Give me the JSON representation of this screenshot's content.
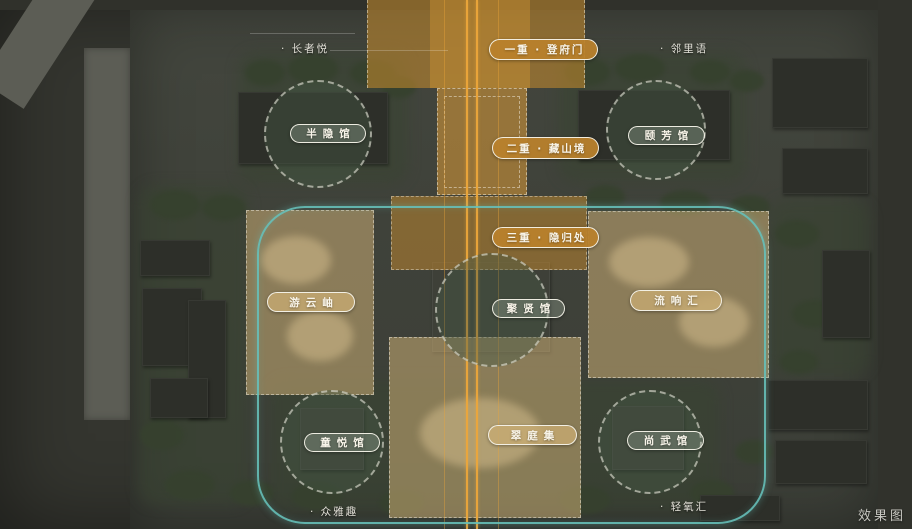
{
  "watermark": "效果图",
  "colors": {
    "axis_orange": "#cb8e2e",
    "axis_line": "#eca63a",
    "teal_loop": "#66c0b9",
    "tan_overlay": "#cbad74",
    "capsule_border": "#f6f3e9",
    "map_base": "#41443c"
  },
  "axis_levels": [
    {
      "label": "一重 · 登府门"
    },
    {
      "label": "二重 · 藏山境"
    },
    {
      "label": "三重 · 隐归处"
    }
  ],
  "venues": [
    {
      "label": "半隐馆"
    },
    {
      "label": "颐芳馆"
    },
    {
      "label": "聚贤馆"
    },
    {
      "label": "童悦馆"
    },
    {
      "label": "尚武馆"
    }
  ],
  "gardens": [
    {
      "label": "游云岫"
    },
    {
      "label": "流响汇"
    },
    {
      "label": "翠庭集"
    }
  ],
  "pois": [
    {
      "label": "· 长者悦"
    },
    {
      "label": "· 邻里语"
    },
    {
      "label": "· 众雅趣"
    },
    {
      "label": "· 轻氧汇"
    }
  ]
}
